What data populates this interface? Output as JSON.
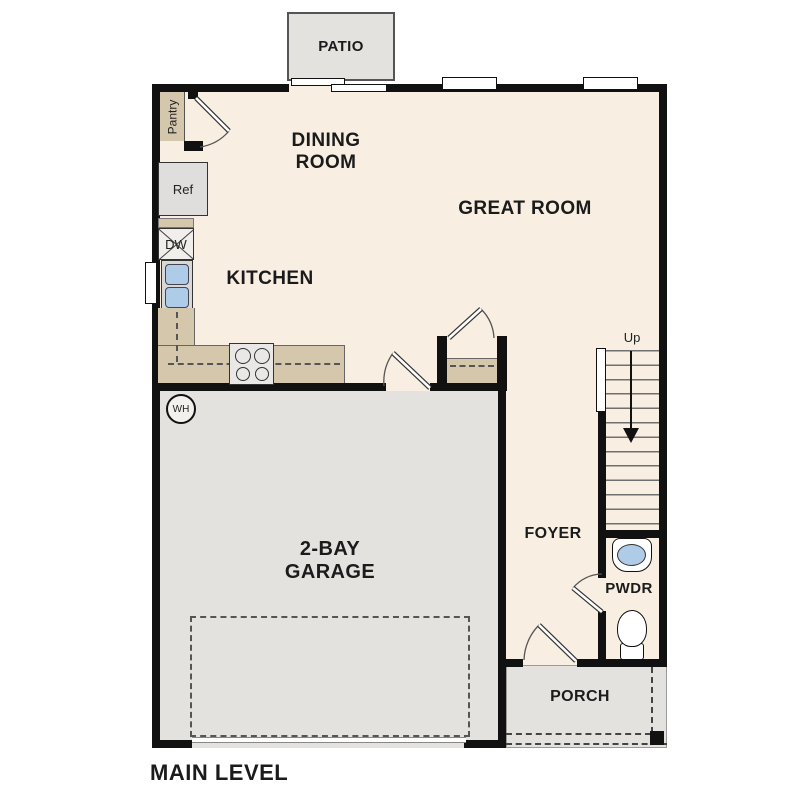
{
  "colors": {
    "wall": "#111111",
    "floor": "#f8efe2",
    "concrete": "#e4e2df",
    "counter": "#d5c7ac",
    "water": "#aecbe8"
  },
  "plan": {
    "title": "MAIN LEVEL",
    "rooms": {
      "patio": "PATIO",
      "dining_room": "DINING\nROOM",
      "great_room": "GREAT ROOM",
      "kitchen": "KITCHEN",
      "garage": "2-BAY\nGARAGE",
      "foyer": "FOYER",
      "pwdr": "PWDR",
      "porch": "PORCH"
    },
    "fixtures": {
      "pantry": "Pantry",
      "ref": "Ref",
      "dw": "DW",
      "wh": "WH",
      "up": "Up"
    }
  }
}
